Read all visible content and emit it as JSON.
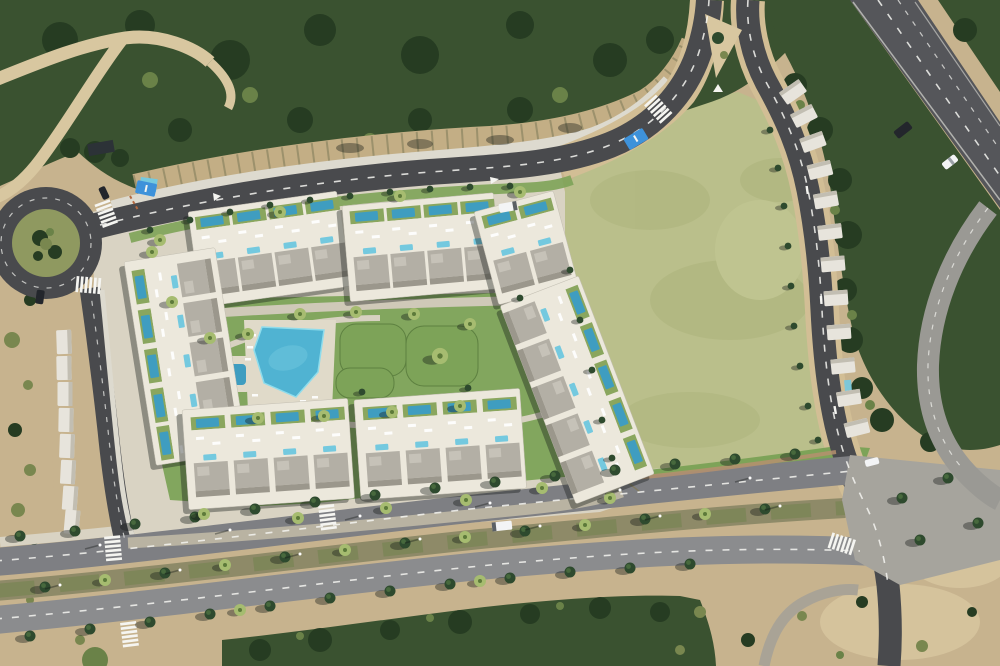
{
  "scene": {
    "title": "Aerial satellite view of coastal villa development",
    "description": "Top-down aerial photo composite: a gated community of white modern villas with private and rooftop pools arranged in seven blocks around a central garden with a large communal pool, bordered by a roundabout (west), a curving access road with rows of white carports (north and east), a large olive-green empty field (east), a tree-lined dual-carriageway boulevard (south) and a highway with two cars (top-right). Dense dark-green scrub forest fills the top-left, dirt tracks and barren ground fill the margins."
  },
  "features": {
    "roundabout_count": 1,
    "villa_block_count": 7,
    "communal_pool_count": 2,
    "bus_bay_count": 2,
    "crosswalk_count": 7,
    "vehicle_count": 7,
    "carport_row_count": 2
  },
  "colors": {
    "dirt": "#c7b38e",
    "dirt_light": "#d8c7a0",
    "forest": "#3a5230",
    "forest_dark": "#263c22",
    "veg_light": "#6a8248",
    "scrub_olive": "#79874f",
    "field": "#babf8b",
    "field_shade": "#acb37b",
    "lawn": "#7da358",
    "lawn_dark": "#5d8040",
    "hedge": "#2e4a2e",
    "tree_light": "#4b6f40",
    "palm": "#a6bc70",
    "palm_dark": "#5d7a3a",
    "road": "#494a4d",
    "boulevard_upper": "#7e7f83",
    "boulevard_lower": "#8b8c8e",
    "median": "#8e8a68",
    "highway": "#55565a",
    "ramp": "#9a9994",
    "intersection": "#a6a49d",
    "pavement": "#d9d3c3",
    "sidewalk": "#d2be95",
    "wall": "#dddacf",
    "rock": "#c3ae85",
    "villa": "#ece8dc",
    "villa_dark": "#9b978c",
    "roof": "#b3afa5",
    "roof_light": "#c6c2b8",
    "carport": "#e7e4dc",
    "carport_shade": "#c2beb2",
    "unit_garden": "#8aa65e",
    "pool": "#3f9dc0",
    "pool_light": "#74c9df",
    "pool_main": "#50b3d2",
    "deck": "#e0dac9",
    "busbay": "#3e92da",
    "marking": "#f5f5f1",
    "shadow": "rgba(18,24,20,0.38)",
    "lamp": "#ffffff",
    "white": "#ffffff",
    "car_dark": "#23262c",
    "car_white": "#f3f4f5",
    "brick": "#b5916e",
    "fence": "#80795a",
    "red_mark": "#b5693f",
    "service": "#b9b3a2",
    "trail": "#a9a396"
  }
}
